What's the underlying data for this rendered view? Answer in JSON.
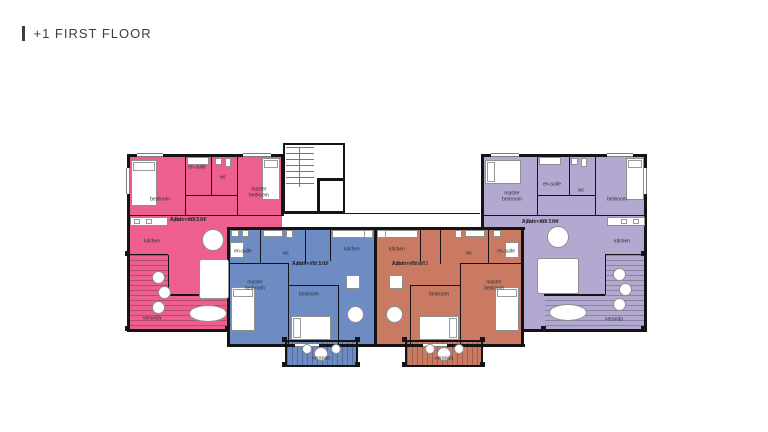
{
  "header": {
    "title": "+1 FIRST FLOOR"
  },
  "colors": {
    "pink": "#ed5f8d",
    "blue": "#6d8cc4",
    "orange": "#ca7a62",
    "purple": "#b3a8d0",
    "wall": "#141414"
  },
  "rooms": {
    "bedroom": "bedroom",
    "master_bedroom": "master bedroom",
    "en_suite": "en-suite",
    "wc": "wc",
    "kitchen": "kitchen",
    "veranda": "veranda"
  },
  "apartments": {
    "a101": {
      "name": "Apartment 101",
      "spec": "2 Bdr - 80.2 m²"
    },
    "a102": {
      "name": "Apartment 102",
      "spec": "2 Bdr - 75.1 m²"
    },
    "a103": {
      "name": "Apartment 103",
      "spec": "2 Bdr - 75 m²"
    },
    "a104": {
      "name": "Apartment 104",
      "spec": "2 Bdr - 80.7 m²"
    }
  }
}
